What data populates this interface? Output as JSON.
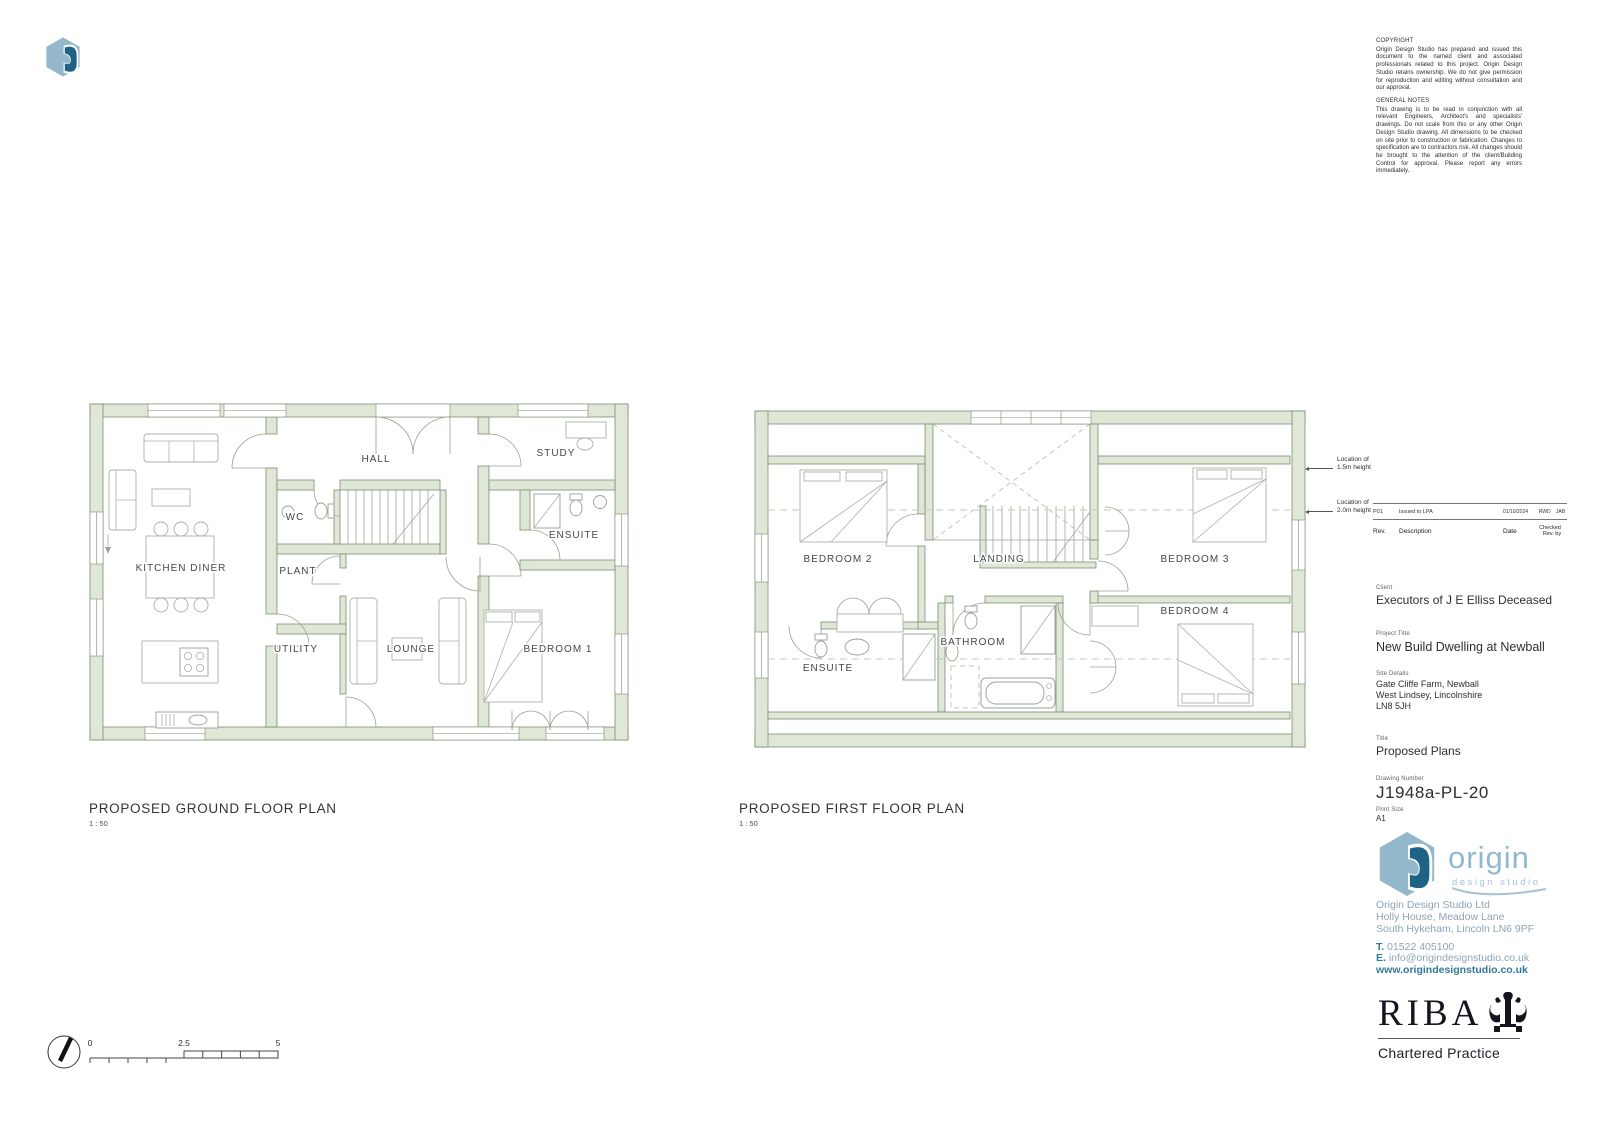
{
  "copyright": {
    "heading": "COPYRIGHT",
    "body": "Origin Design Studio has prepared and issued this document to the named client and associated professionals related to this project. Origin Design Studio retains ownership. We do not give permission for reproduction and editing without consultation and our approval."
  },
  "general_notes": {
    "heading": "GENERAL NOTES",
    "body": "This drawing is to be read in conjunction with all relevant Engineers, Architect's and specialists' drawings. Do not scale from this or any other Origin Design Studio drawing. All dimensions to be checked on site prior to construction or fabrication. Changes to specification are to contractors risk. All changes should be brought to the attention of the client/Building Control for approval. Please report any errors immediately."
  },
  "revision": {
    "row": {
      "rev": "P01",
      "description": "Issued to LPA",
      "date": "01/10/2024",
      "checked": "RWD",
      "rev_by": "JAB"
    },
    "headers": {
      "rev": "Rev.",
      "description": "Description",
      "date": "Date",
      "checked": "Checked",
      "rev_by": "Rev. by"
    }
  },
  "title_block": {
    "client_label": "Client",
    "client": "Executors of J E Elliss Deceased",
    "project_label": "Project Title",
    "project": "New Build Dwelling at Newball",
    "site_label": "Site Details",
    "site1": "Gate Cliffe Farm, Newball",
    "site2": "West Lindsey, Lincolnshire",
    "site3": "LN8 5JH",
    "title_label": "Title",
    "title": "Proposed Plans",
    "drawing_label": "Drawing Number",
    "drawing_number": "J1948a-PL-20",
    "print_label": "Print Size",
    "print_size": "A1"
  },
  "plans": {
    "ground": {
      "title": "PROPOSED GROUND FLOOR PLAN",
      "scale": "1 : 50",
      "rooms": {
        "kitchen_diner": "KITCHEN DINER",
        "hall": "HALL",
        "wc": "WC",
        "plant": "PLANT",
        "utility": "UTILITY",
        "lounge": "LOUNGE",
        "study": "STUDY",
        "ensuite": "ENSUITE",
        "bedroom1": "BEDROOM 1"
      }
    },
    "first": {
      "title": "PROPOSED FIRST FLOOR PLAN",
      "scale": "1 : 50",
      "rooms": {
        "bedroom2": "BEDROOM 2",
        "landing": "LANDING",
        "bedroom3": "BEDROOM 3",
        "bedroom4": "BEDROOM 4",
        "ensuite": "ENSUITE",
        "bathroom": "BATHROOM"
      }
    }
  },
  "annotations": {
    "loc15_line1": "Location of",
    "loc15_line2": "1.5m height",
    "loc20_line1": "Location of",
    "loc20_line2": "2.0m height"
  },
  "scale_bar": {
    "zero": "0",
    "mid": "2.5",
    "max": "5"
  },
  "branding": {
    "logo_word": "origin",
    "logo_sub": "design studio",
    "company": "Origin Design Studio Ltd",
    "address1": "Holly House, Meadow Lane",
    "address2": "South Hykeham, Lincoln LN6 9PF",
    "phone_label": "T.",
    "phone": " 01522 405100",
    "email_label": "E.",
    "email": " info@origindesignstudio.co.uk",
    "website": "www.origindesignstudio.co.uk"
  },
  "riba": {
    "name": "RIBA",
    "tagline": "Chartered Practice"
  },
  "colors": {
    "wall_fill": "#dfe7d6",
    "wall_stroke": "#7e8b75",
    "origin_light": "#8fb9ce",
    "origin_dark": "#1e6286",
    "riba_ink": "#15151f"
  }
}
